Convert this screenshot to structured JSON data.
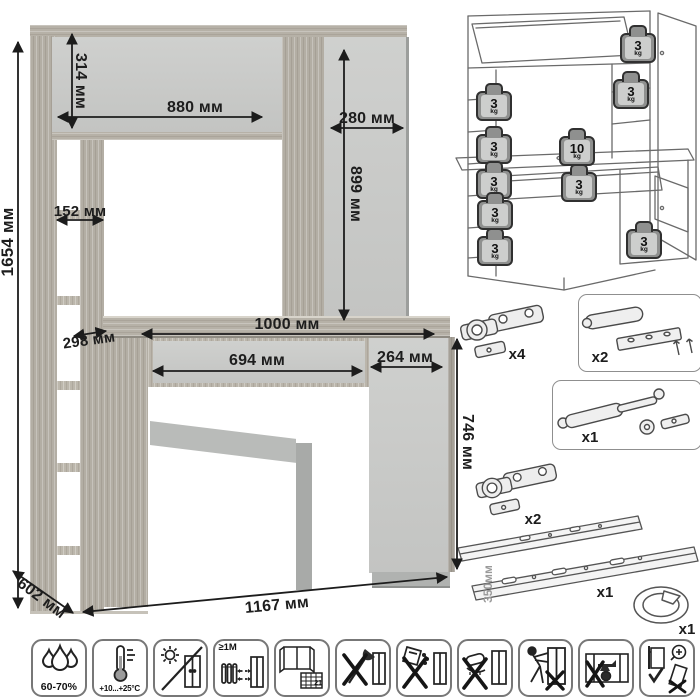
{
  "colors": {
    "wood": "#b3aea4",
    "panel_gray": "#c7c8c6",
    "dimension_text": "#1d1d1d",
    "outline_gray": "#6a6a6a",
    "weight_fill": "#8f908f",
    "icon_border": "#777777"
  },
  "dims": [
    {
      "name": "total-height",
      "label": "1654 мм"
    },
    {
      "name": "top-cabinet-height",
      "label": "314 мм"
    },
    {
      "name": "top-door-width",
      "label": "880 мм"
    },
    {
      "name": "right-column-width",
      "label": "280 мм"
    },
    {
      "name": "right-column-height",
      "label": "899 мм"
    },
    {
      "name": "shelf-opening-width",
      "label": "152 мм"
    },
    {
      "name": "shelf-depth",
      "label": "298 мм"
    },
    {
      "name": "desktop-width",
      "label": "1000 мм"
    },
    {
      "name": "drawer-width",
      "label": "694 мм"
    },
    {
      "name": "pedestal-width",
      "label": "264 мм"
    },
    {
      "name": "desk-height",
      "label": "746 мм"
    },
    {
      "name": "depth",
      "label": "602 мм"
    },
    {
      "name": "total-width",
      "label": "1167 мм"
    }
  ],
  "load_diagram": {
    "weights": [
      {
        "value": "3",
        "unit": "kg"
      },
      {
        "value": "3",
        "unit": "kg"
      },
      {
        "value": "3",
        "unit": "kg"
      },
      {
        "value": "3",
        "unit": "kg"
      },
      {
        "value": "10",
        "unit": "kg"
      },
      {
        "value": "3",
        "unit": "kg"
      },
      {
        "value": "3",
        "unit": "kg"
      },
      {
        "value": "3",
        "unit": "kg"
      },
      {
        "value": "3",
        "unit": "kg"
      },
      {
        "value": "3",
        "unit": "kg"
      }
    ]
  },
  "hardware": {
    "hinge_top": {
      "qty": "x4"
    },
    "damper": {
      "qty": "x2"
    },
    "gas_lift": {
      "qty": "x1"
    },
    "hinge_bottom": {
      "qty": "x2"
    },
    "slides": {
      "qty": "x1",
      "length": "350мм"
    },
    "grommet": {
      "qty": "x1"
    }
  },
  "care": {
    "humidity": {
      "label": "60-70%"
    },
    "temperature": {
      "label": "+10...+25°C"
    },
    "heat_distance": {
      "label": "≥1М"
    },
    "ventilation": {
      "label": "21"
    }
  }
}
